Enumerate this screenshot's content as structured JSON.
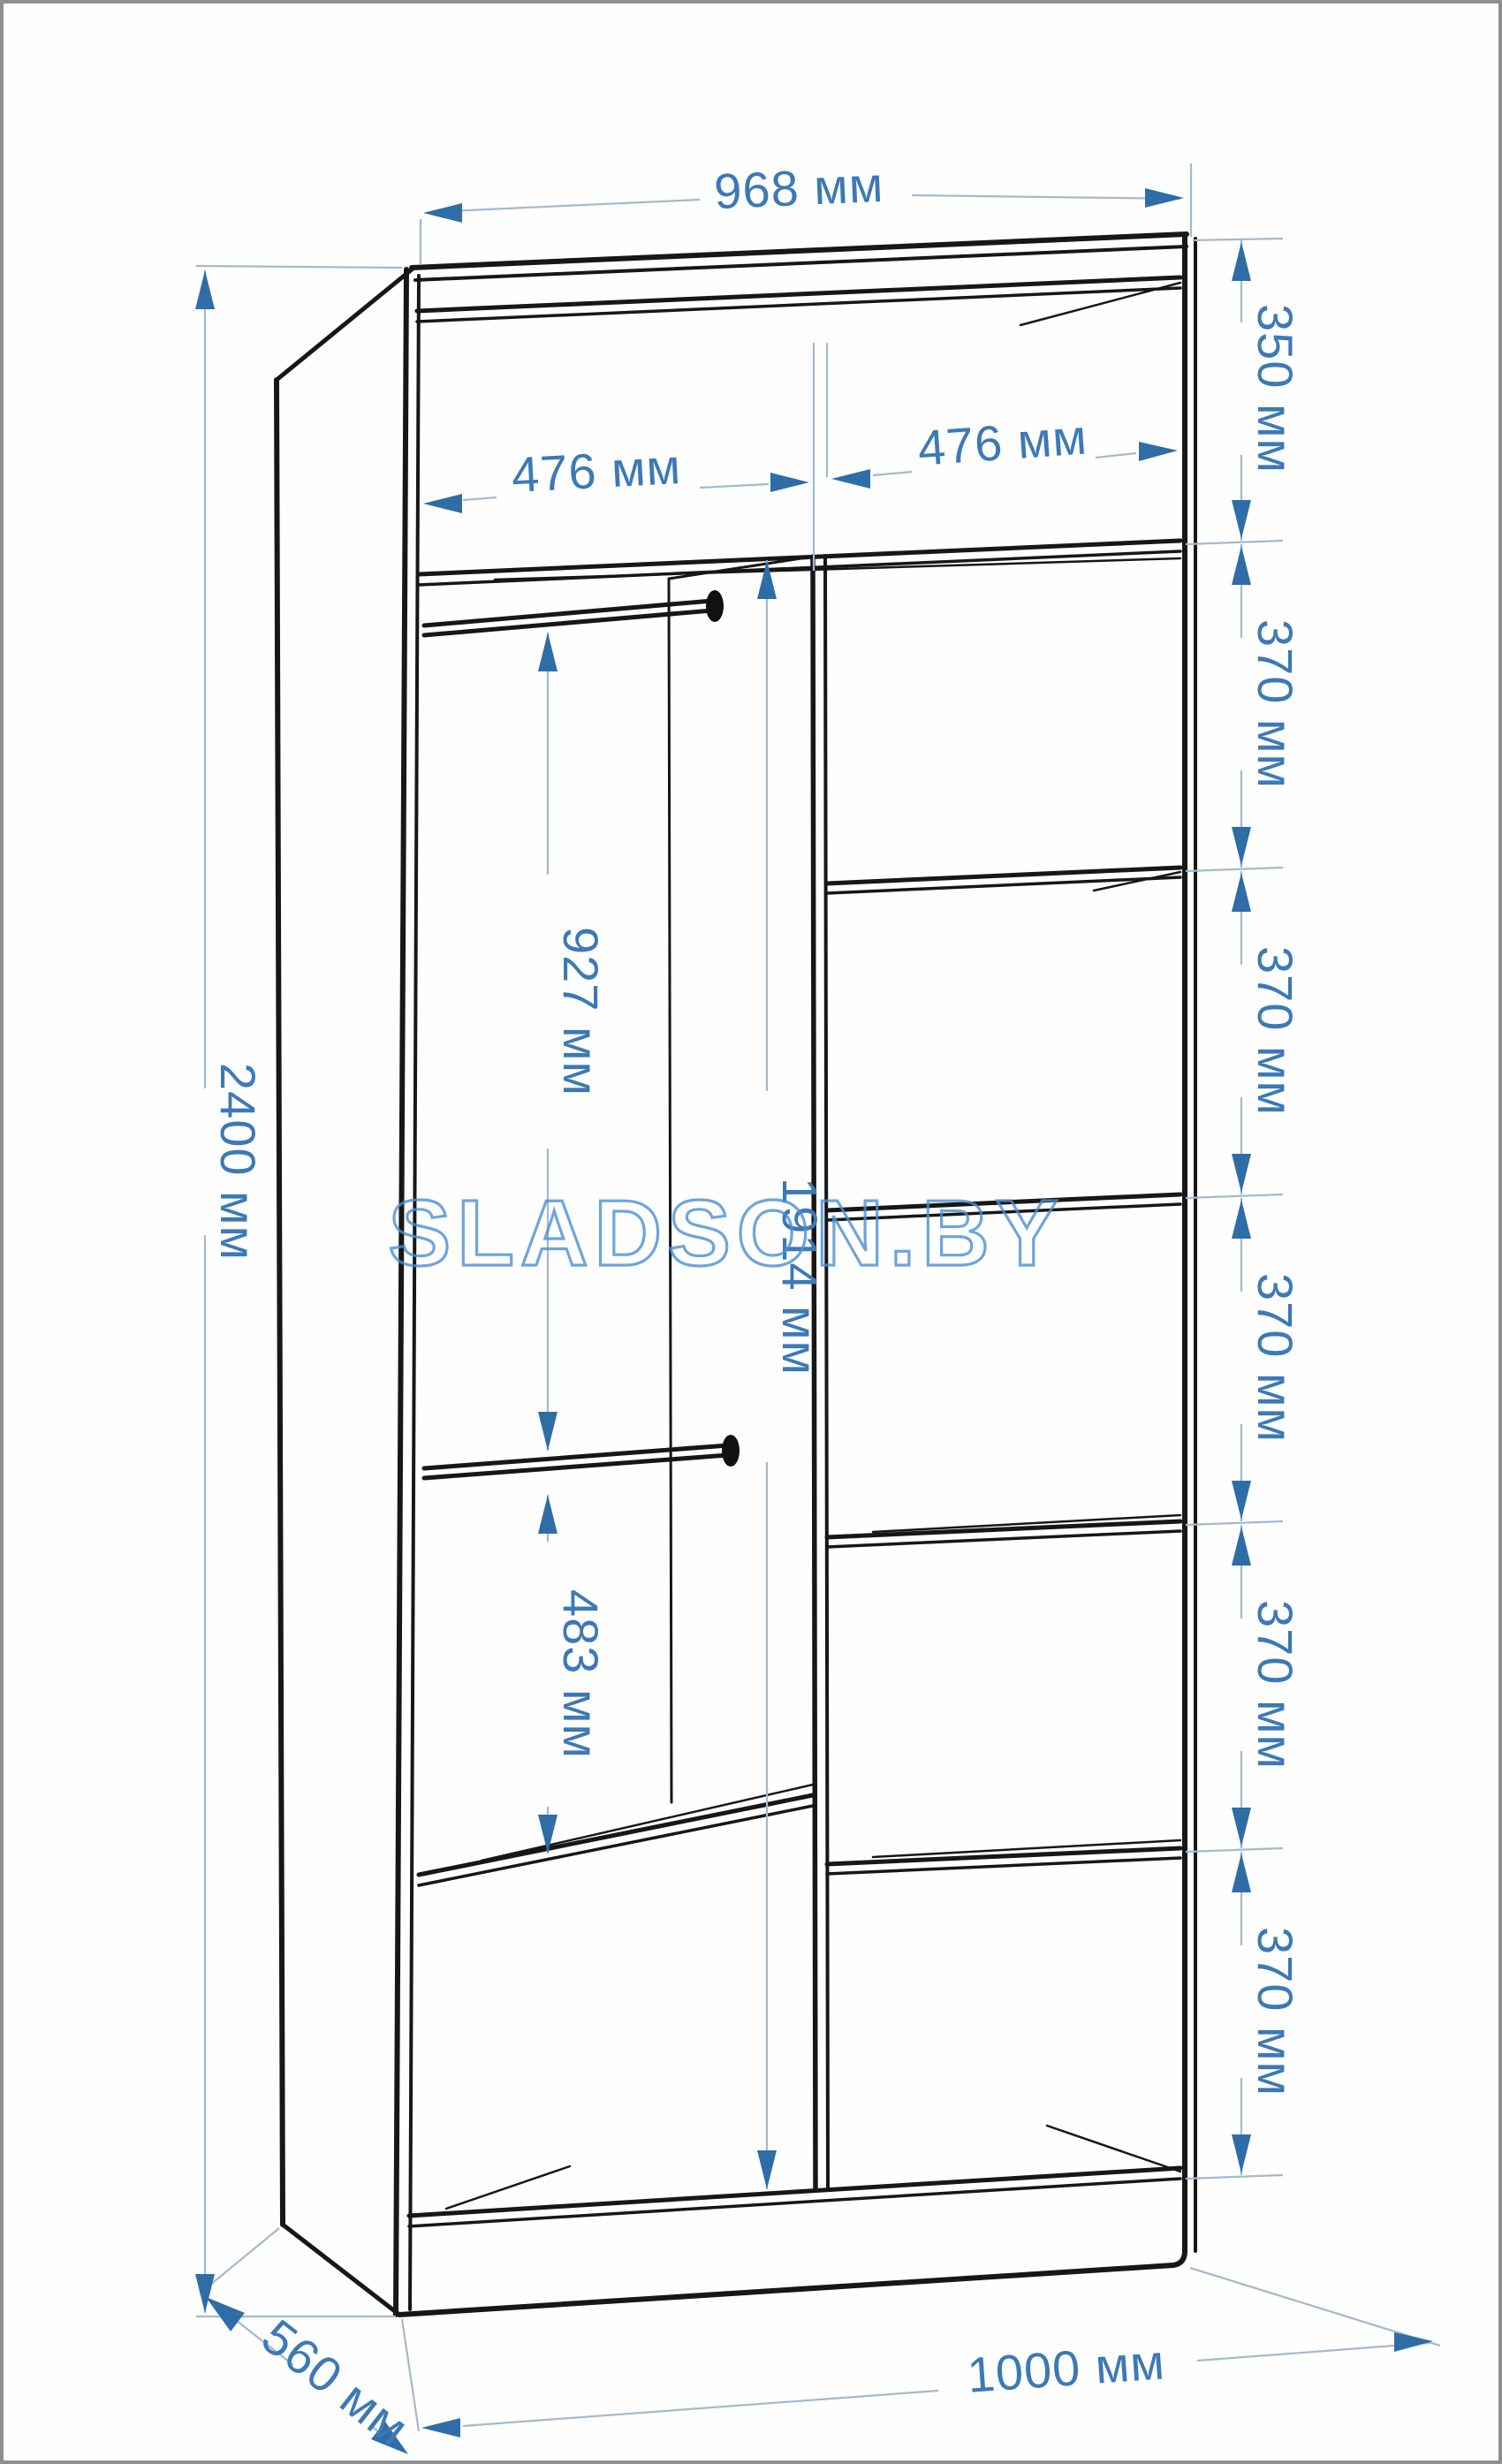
{
  "units": "мм",
  "watermark": {
    "text": "SLADSON.BY",
    "color": "#4a8fd3"
  },
  "colors": {
    "dimension_text": "#3c79b6",
    "arrowhead": "#2e6da6",
    "leader_line": "#a3bace",
    "drawing_line": "#171717",
    "page_border": "#8f8f8f",
    "background": "#fefefe"
  },
  "drawing": {
    "type": "wardrobe-dimension-diagram",
    "view": "open front, slight perspective, left side and interior visible"
  },
  "dimensions": {
    "top_width": "968 мм",
    "total_height": "2400 мм",
    "depth": "560 мм",
    "bottom_width": "1000 мм",
    "left_compartment_width": "476 мм",
    "right_compartment_width": "476 мм",
    "top_section_height": "350 мм",
    "shelf_spacings": [
      "370 мм",
      "370 мм",
      "370 мм",
      "370 мм",
      "370 мм"
    ],
    "rod_drop_height": "927 мм",
    "interior_height": "1914 мм",
    "lower_section_height": "483 мм"
  }
}
